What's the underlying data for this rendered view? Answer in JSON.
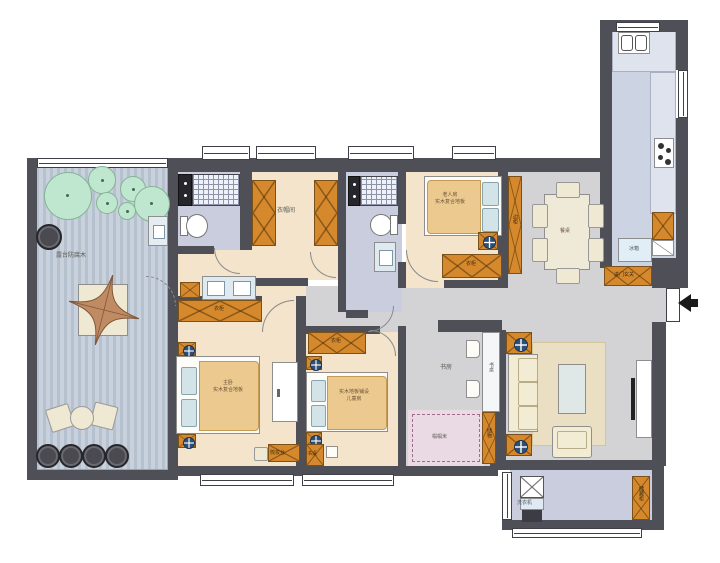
{
  "labels": {
    "terrace": "露台防腐木",
    "closet": "衣帽间",
    "elderly_room": "老人房",
    "elderly_floor": "实木复合地板",
    "elderly_wardrobe": "衣柜",
    "sideboard": "边柜",
    "dining_table": "餐桌",
    "fridge": "冰箱",
    "entry_cabinet": "进门玄关",
    "master_room": "主卧",
    "master_floor": "实木复合地板",
    "master_wardrobe": "衣柜",
    "dressing_table": "梳妆台",
    "children_floor": "实木地板铺设",
    "children_room": "儿童房",
    "children_wardrobe": "衣柜",
    "children_desk": "书桌",
    "study": "书房",
    "study_desk": "书桌",
    "tatami": "榻榻米",
    "tatami_cabinet": "储物",
    "washer": "洗衣机",
    "balcony_cabinet": "储藏柜"
  },
  "colors": {
    "wall": "#4f4f58",
    "floor_wood": "#f3e4cb",
    "floor_bath": "#c9cdde",
    "floor_gray": "#d3d3d6",
    "floor_kitchen": "#ccd3e2",
    "cabinet_orange": "#d5892c",
    "terrace_deck": "#bcc7d3",
    "tatami_pink": "#eadae3",
    "tree_green": "#bfe7cf"
  }
}
